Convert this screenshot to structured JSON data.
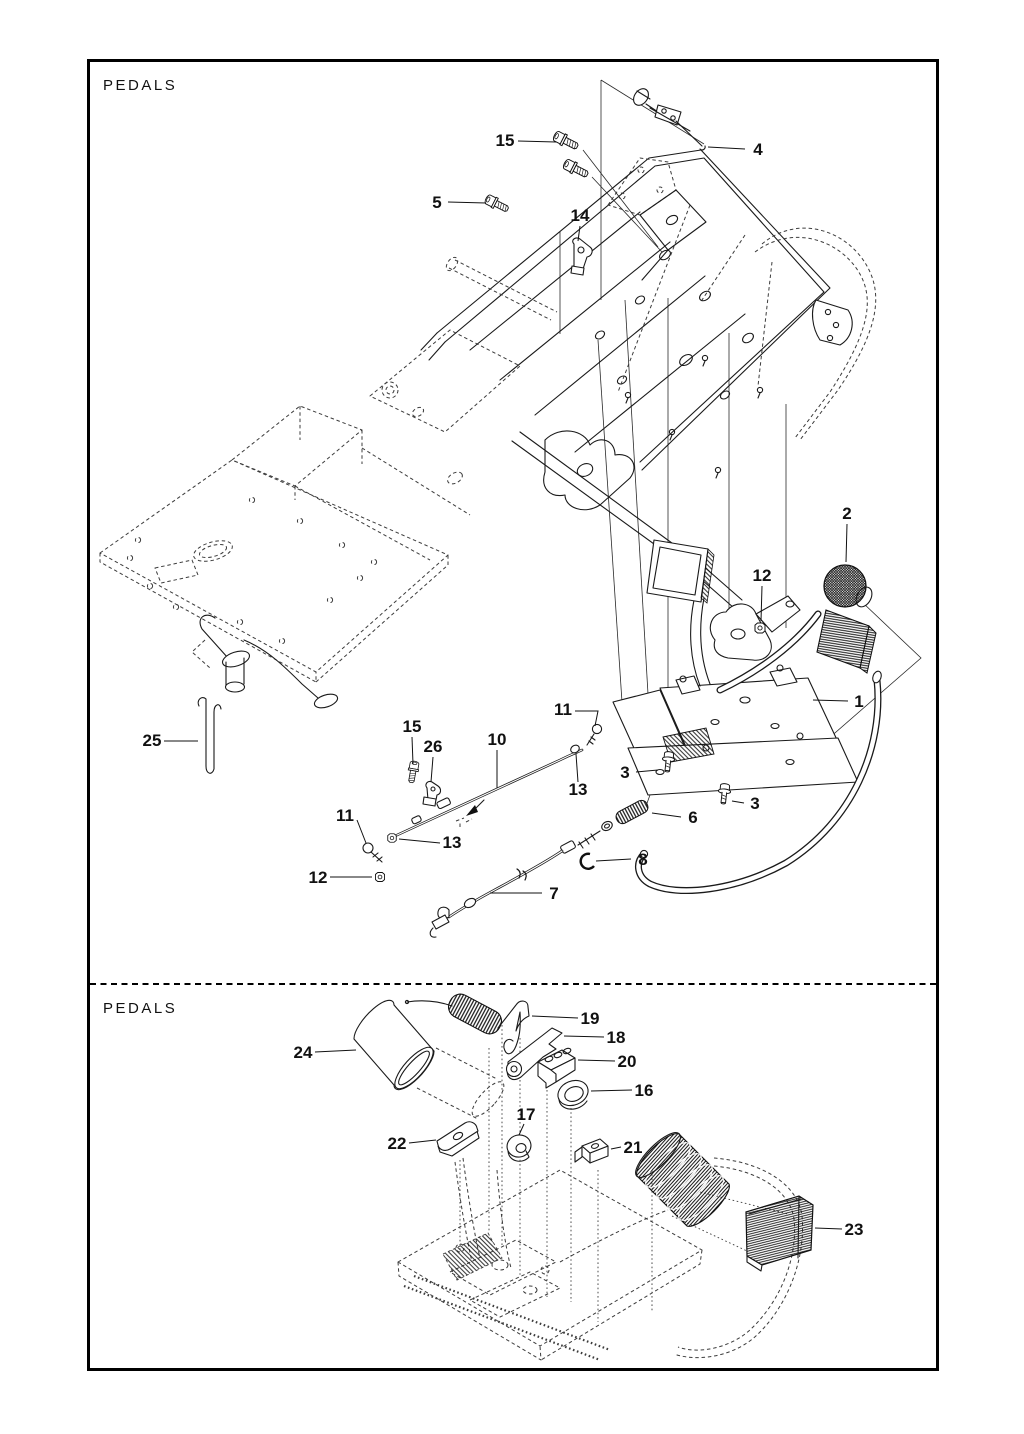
{
  "document_kind": "exploded-parts-diagram",
  "colors": {
    "line": "#1a1a1a",
    "background": "#ffffff",
    "border": "#000000"
  },
  "sections": {
    "top": {
      "label": "PEDALS"
    },
    "bottom": {
      "label": "PEDALS"
    }
  },
  "callouts": {
    "top": [
      {
        "num": "15"
      },
      {
        "num": "4"
      },
      {
        "num": "5"
      },
      {
        "num": "14"
      },
      {
        "num": "2"
      },
      {
        "num": "12"
      },
      {
        "num": "1"
      },
      {
        "num": "3"
      },
      {
        "num": "3"
      },
      {
        "num": "11"
      },
      {
        "num": "13"
      },
      {
        "num": "10"
      },
      {
        "num": "15"
      },
      {
        "num": "26"
      },
      {
        "num": "11"
      },
      {
        "num": "13"
      },
      {
        "num": "12"
      },
      {
        "num": "25"
      },
      {
        "num": "6"
      },
      {
        "num": "8"
      },
      {
        "num": "7"
      }
    ],
    "bottom": [
      {
        "num": "19"
      },
      {
        "num": "18"
      },
      {
        "num": "20"
      },
      {
        "num": "16"
      },
      {
        "num": "17"
      },
      {
        "num": "21"
      },
      {
        "num": "22"
      },
      {
        "num": "24"
      },
      {
        "num": "23"
      }
    ]
  }
}
